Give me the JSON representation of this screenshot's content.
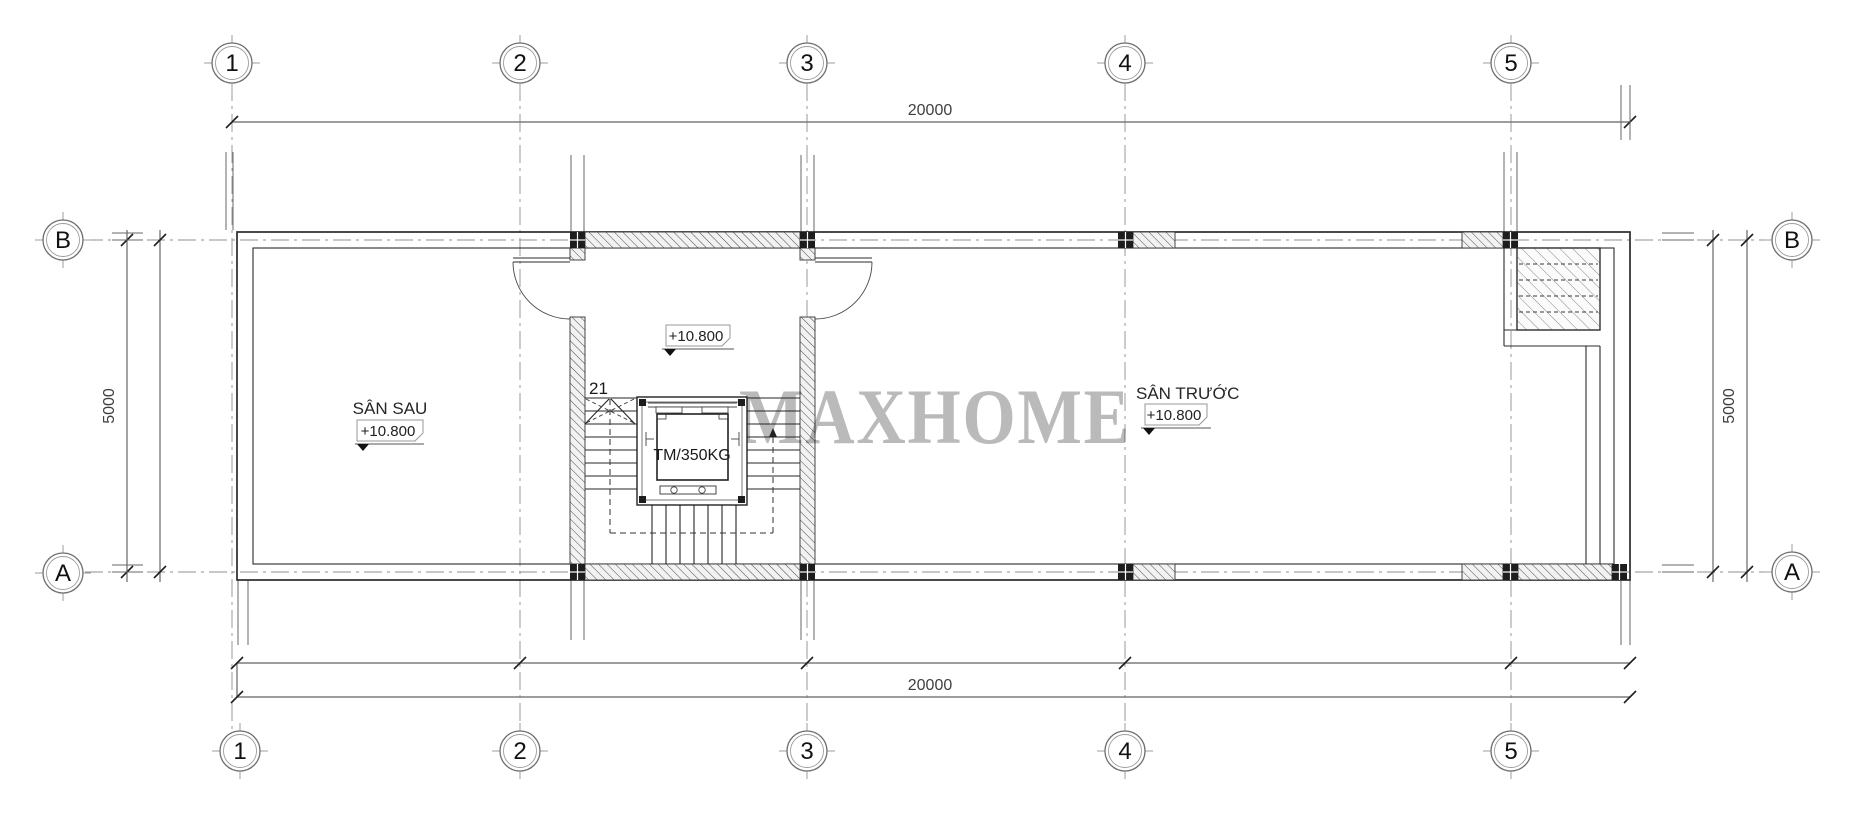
{
  "drawing": {
    "watermark": "MAXHOME",
    "grid_columns": [
      "1",
      "2",
      "3",
      "4",
      "5"
    ],
    "grid_rows": {
      "top": "B",
      "bottom": "A"
    },
    "dimensions": {
      "overall_width_top": "20000",
      "overall_width_bottom": "20000",
      "overall_depth_left": "5000",
      "overall_depth_right": "5000"
    },
    "rooms": {
      "back_yard": {
        "name": "SÂN SAU",
        "level": "+10.800"
      },
      "hall": {
        "level": "+10.800"
      },
      "front_yard": {
        "name": "SÂN TRƯỚC",
        "level": "+10.800"
      },
      "stair": {
        "step_number": "21"
      },
      "elevator": {
        "label": "TM/350KG"
      }
    },
    "colors": {
      "line": "#2b2b2b",
      "grid_line": "#8f8f8f",
      "watermark_gray": "#b4b4b4"
    }
  }
}
